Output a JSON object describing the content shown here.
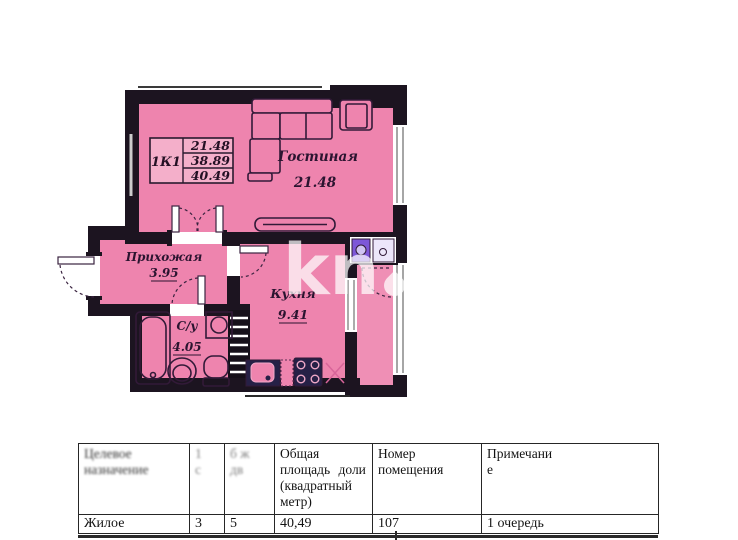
{
  "floor_plan": {
    "stamp": {
      "unit_label": "1К1",
      "area_values": [
        "21.48",
        "38.89",
        "40.49"
      ]
    },
    "rooms": {
      "living": {
        "name": "Гостиная",
        "area": "21.48"
      },
      "hallway": {
        "name": "Прихожая",
        "area": "3.95"
      },
      "bathroom": {
        "name": "С/у",
        "area": "4.05"
      },
      "kitchen": {
        "name": "Кухня",
        "area": "9.41"
      }
    },
    "watermark": {
      "left": "kn",
      "right": "kz"
    },
    "colors": {
      "room_fill": "#ee84ae",
      "wall": "#1c1420",
      "furniture_outline": "#321a38",
      "appliance_dark": "#262046",
      "appliance_purple": "#7d57d8",
      "window_line": "#8f8f8f"
    }
  },
  "table": {
    "headers": [
      "Целевое\nназначение",
      "1\nс",
      "б ж\nдв",
      "Общая\nплощадь доли\n(квадратный\nметр)",
      "Номер\nпомещения",
      "Примечани\nе"
    ],
    "row": [
      "Жилое",
      "3",
      "5",
      "40,49",
      "107",
      "1 очередь"
    ]
  }
}
